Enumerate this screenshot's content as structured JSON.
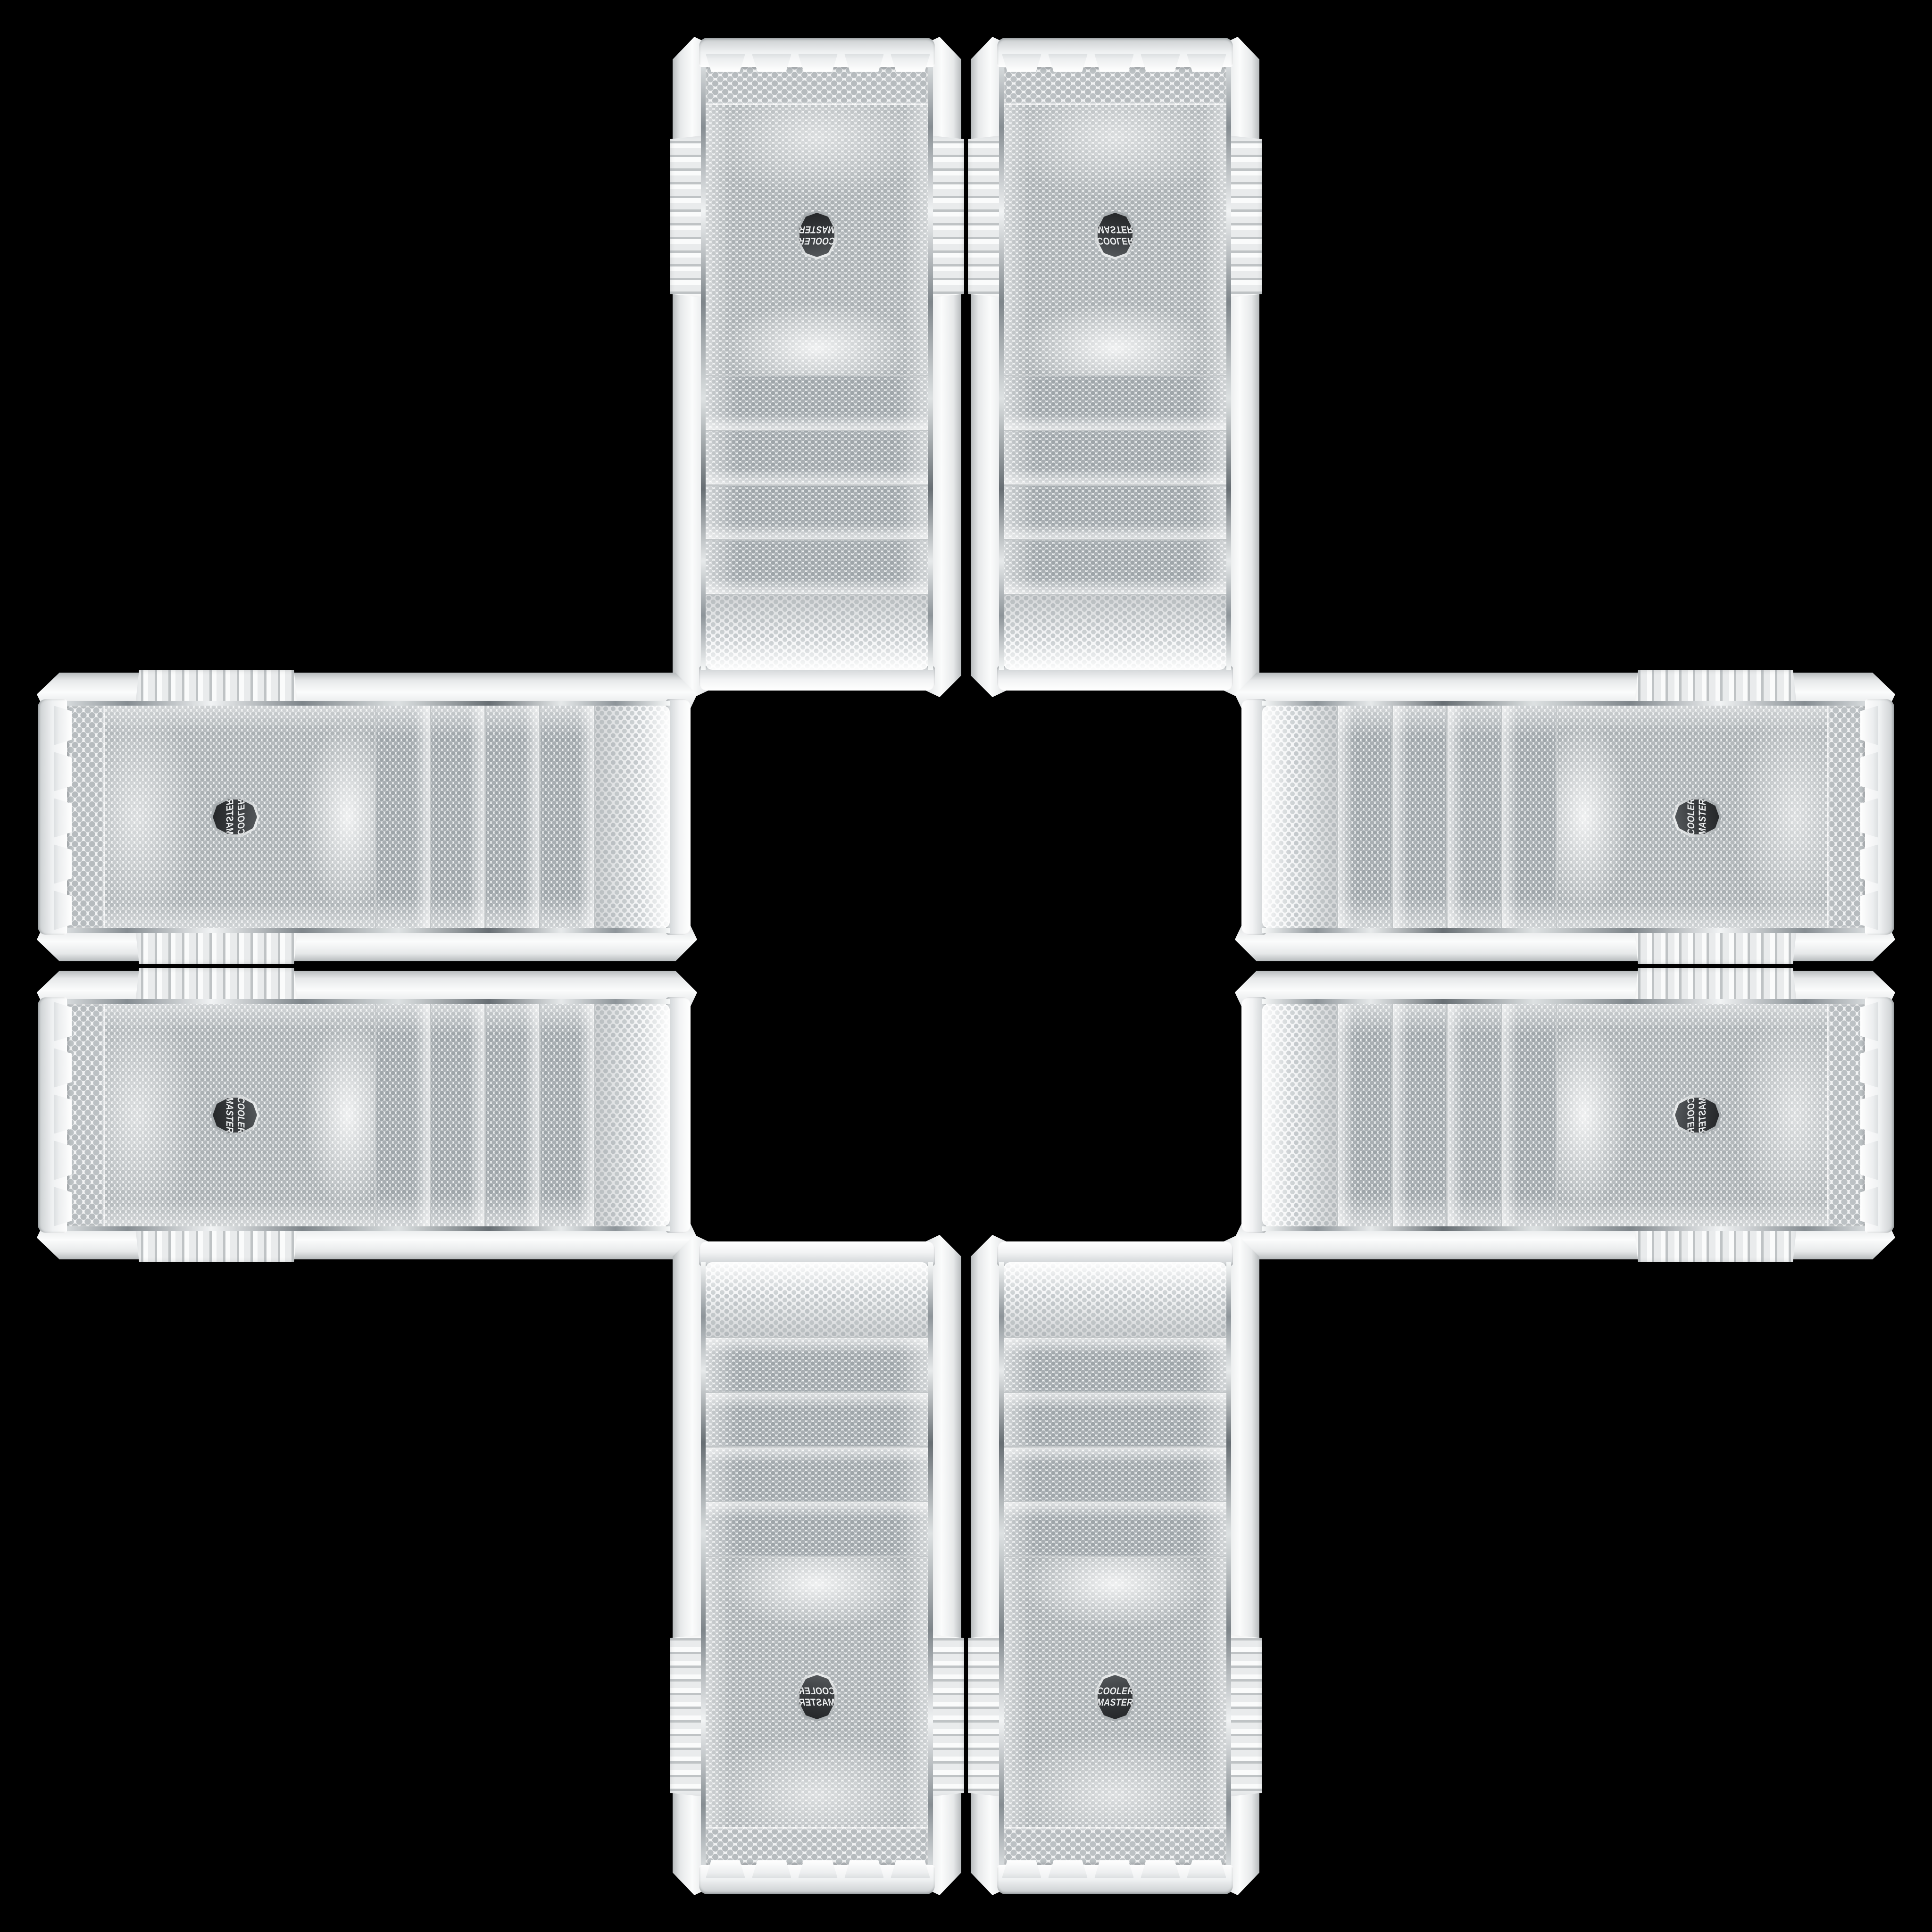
{
  "brand": {
    "line1": "COOLER",
    "line2": "MASTER"
  },
  "scene": {
    "layout": "eight identical white Cooler Master case front panels arranged in a cross on black",
    "panel_count": 8
  },
  "panels": [
    {
      "id": "top-left",
      "orientation": "vertical, rotated 180°"
    },
    {
      "id": "top-right",
      "orientation": "vertical, flipped vertically"
    },
    {
      "id": "left-top",
      "orientation": "horizontal, rotated -90° mirrored"
    },
    {
      "id": "left-bottom",
      "orientation": "horizontal, rotated 90°"
    },
    {
      "id": "right-top",
      "orientation": "horizontal, rotated -90°"
    },
    {
      "id": "right-bottom",
      "orientation": "horizontal, rotated -90° flipped"
    },
    {
      "id": "bottom-left",
      "orientation": "vertical, mirrored"
    },
    {
      "id": "bottom-right",
      "orientation": "vertical, upright"
    }
  ],
  "colors": {
    "background": "#000000",
    "panel_white": "#f2f3f4",
    "panel_shadow": "#c6cacc",
    "mesh_base": "#f0f2f3",
    "mesh_dot": "#aab0b3",
    "chrome": "#8d9499",
    "badge_bg": "#3a3d40",
    "badge_text": "#eef0f1"
  }
}
